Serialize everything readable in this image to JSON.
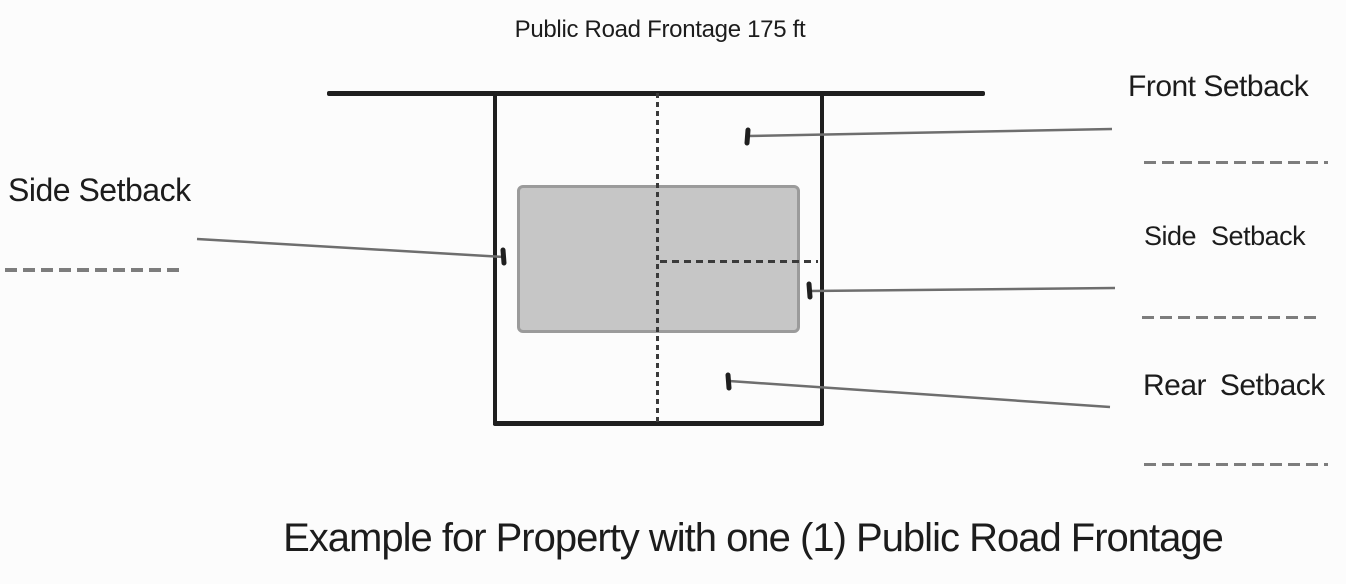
{
  "title": "Public Road Frontage 175 ft",
  "caption": "Example for Property with one (1) Public Road Frontage",
  "labels": {
    "left_side": "Side Setback",
    "front": "Front Setback",
    "right_side": "Side Setback",
    "rear": "Rear Setback"
  },
  "colors": {
    "line_dark": "#1f1f1f",
    "leader_gray": "#6e6e6e",
    "dash_gray": "#7d7d7d",
    "building_fill": "#c6c6c6",
    "building_border": "#9b9b9b",
    "text": "#1c1c1c",
    "background": "#fcfcfc"
  }
}
